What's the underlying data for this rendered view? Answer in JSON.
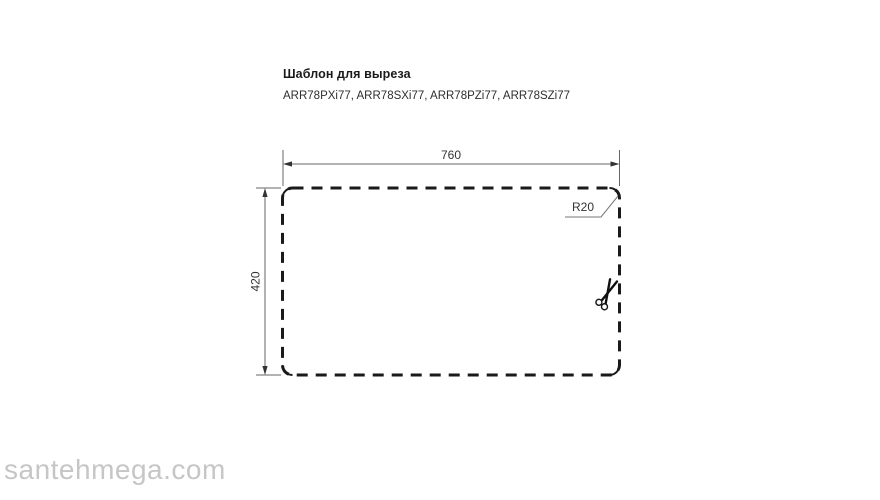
{
  "page": {
    "background": "#ffffff"
  },
  "header": {
    "title": "Шаблон для выреза",
    "models": "ARR78PXi77, ARR78SXi77, ARR78PZi77, ARR78SZi77"
  },
  "drawing": {
    "width_dim": "760",
    "height_dim": "420",
    "corner_radius": "R20",
    "outline_color": "#1a1a1a",
    "dimension_color": "#666666",
    "label_color": "#333333",
    "scissors_icon": "scissors-cut-mark"
  },
  "watermark": {
    "text": "santehmega.com",
    "color": "#c6c6c6"
  }
}
